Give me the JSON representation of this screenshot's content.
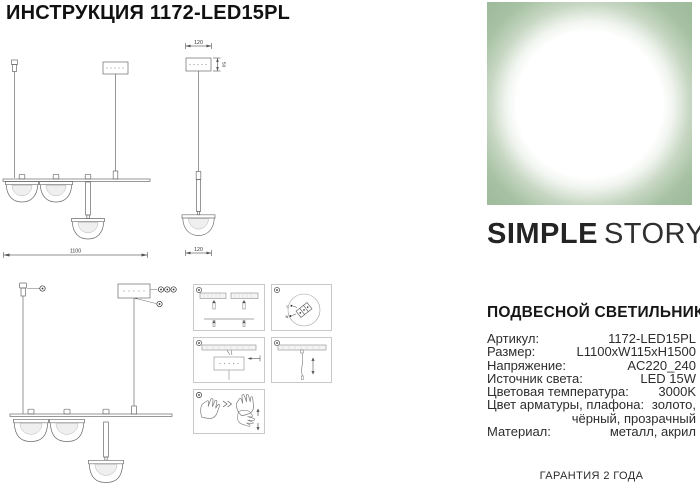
{
  "page": {
    "title": "ИНСТРУКЦИЯ 1172-LED15PL",
    "footer": "ГАРАНТИЯ 2 ГОДА"
  },
  "brand": {
    "logo_primary": "SIMPLE",
    "logo_secondary": "STORY",
    "image_bg_color": "#9bb999"
  },
  "product": {
    "heading": "ПОДВЕСНОЙ СВЕТИЛЬНИК",
    "specs": [
      {
        "label": "Артикул:",
        "value": "1172-LED15PL"
      },
      {
        "label": "Размер:",
        "value": "L1100xW115xH1500"
      },
      {
        "label": "Напряжение:",
        "value": "AC220_240"
      },
      {
        "label": "Источник света:",
        "value": "LED 15W"
      },
      {
        "label": "Цветовая температура:",
        "value": "3000K"
      },
      {
        "label": "Цвет арматуры, плафона:",
        "value": "золото, чёрный, прозрачный"
      },
      {
        "label": "Материал:",
        "value": "металл, акрил"
      }
    ]
  },
  "drawings": {
    "front_view": {
      "length_label": "1100"
    },
    "side_view": {
      "width_top_label": "120",
      "width_bottom_label": "120",
      "height_label": "50"
    },
    "wiring": {
      "line_label": "L",
      "neutral_label": "N"
    }
  }
}
